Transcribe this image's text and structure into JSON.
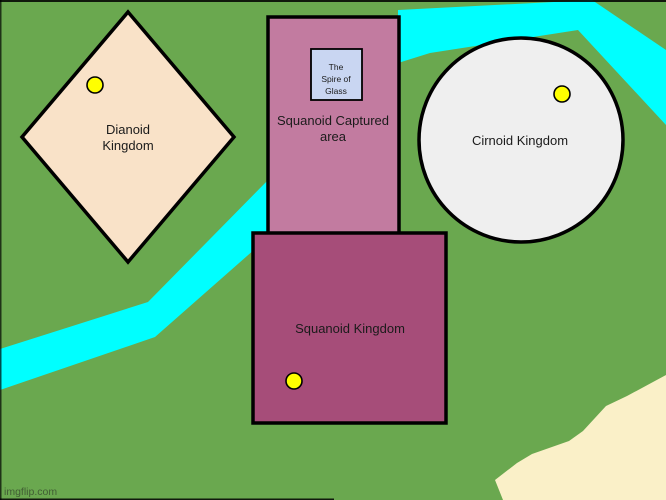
{
  "colors": {
    "background": "#6aa84f",
    "river": "#00ffff",
    "sand": "#faf0c8",
    "outline": "#000000",
    "dianoid_fill": "#f9e2c8",
    "captured_fill": "#c27ba0",
    "squanoid_fill": "#a64d79",
    "cirnoid_fill": "#efefef",
    "spire_fill": "#c9d6f2",
    "marker_fill": "#ffff00"
  },
  "map": {
    "regions": {
      "dianoid": {
        "name_line1": "Dianoid",
        "name_line2": "Kingdom"
      },
      "captured_area": {
        "name_line1": "Squanoid Captured",
        "name_line2": "area"
      },
      "spire": {
        "name_line1": "The",
        "name_line2": "Spire of",
        "name_line3": "Glass"
      },
      "cirnoid": {
        "name": "Cirnoid Kingdom"
      },
      "squanoid": {
        "name": "Squanoid Kingdom"
      }
    }
  },
  "watermark": {
    "text": "imgflip.com"
  }
}
